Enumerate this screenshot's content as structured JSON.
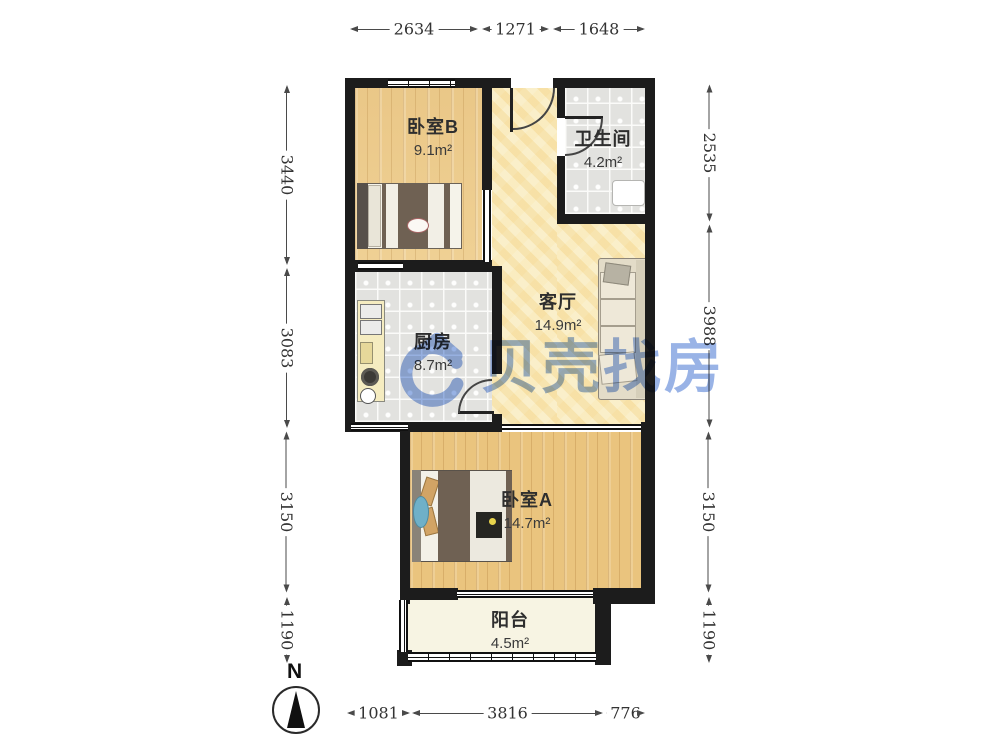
{
  "plan": {
    "type": "apartment-floor-plan",
    "watermark": {
      "brand_text": "贝壳找房",
      "brand_color": "#4f7bd4"
    },
    "compass": {
      "label": "N"
    }
  },
  "rooms": [
    {
      "id": "bedroom-b",
      "name": "卧室B",
      "area": "9.1m²"
    },
    {
      "id": "bathroom",
      "name": "卫生间",
      "area": "4.2m²"
    },
    {
      "id": "living",
      "name": "客厅",
      "area": "14.9m²"
    },
    {
      "id": "kitchen",
      "name": "厨房",
      "area": "8.7m²"
    },
    {
      "id": "bedroom-a",
      "name": "卧室A",
      "area": "14.7m²"
    },
    {
      "id": "balcony",
      "name": "阳台",
      "area": "4.5m²"
    }
  ],
  "dimensions": {
    "top": [
      "2634",
      "1271",
      "1648"
    ],
    "bottom": [
      "1081",
      "3816",
      "776"
    ],
    "left": [
      "3440",
      "3083",
      "3150",
      "1190"
    ],
    "right": [
      "2535",
      "3988",
      "3150",
      "1190"
    ]
  },
  "colors": {
    "wall": "#1c1c1c",
    "wood_floor": "#edcd90",
    "tile_floor": "#e2e2df",
    "living_floor": "#f8ecc2",
    "balcony_floor": "#f7f4e3",
    "watermark_blue": "#4f7bd4"
  }
}
